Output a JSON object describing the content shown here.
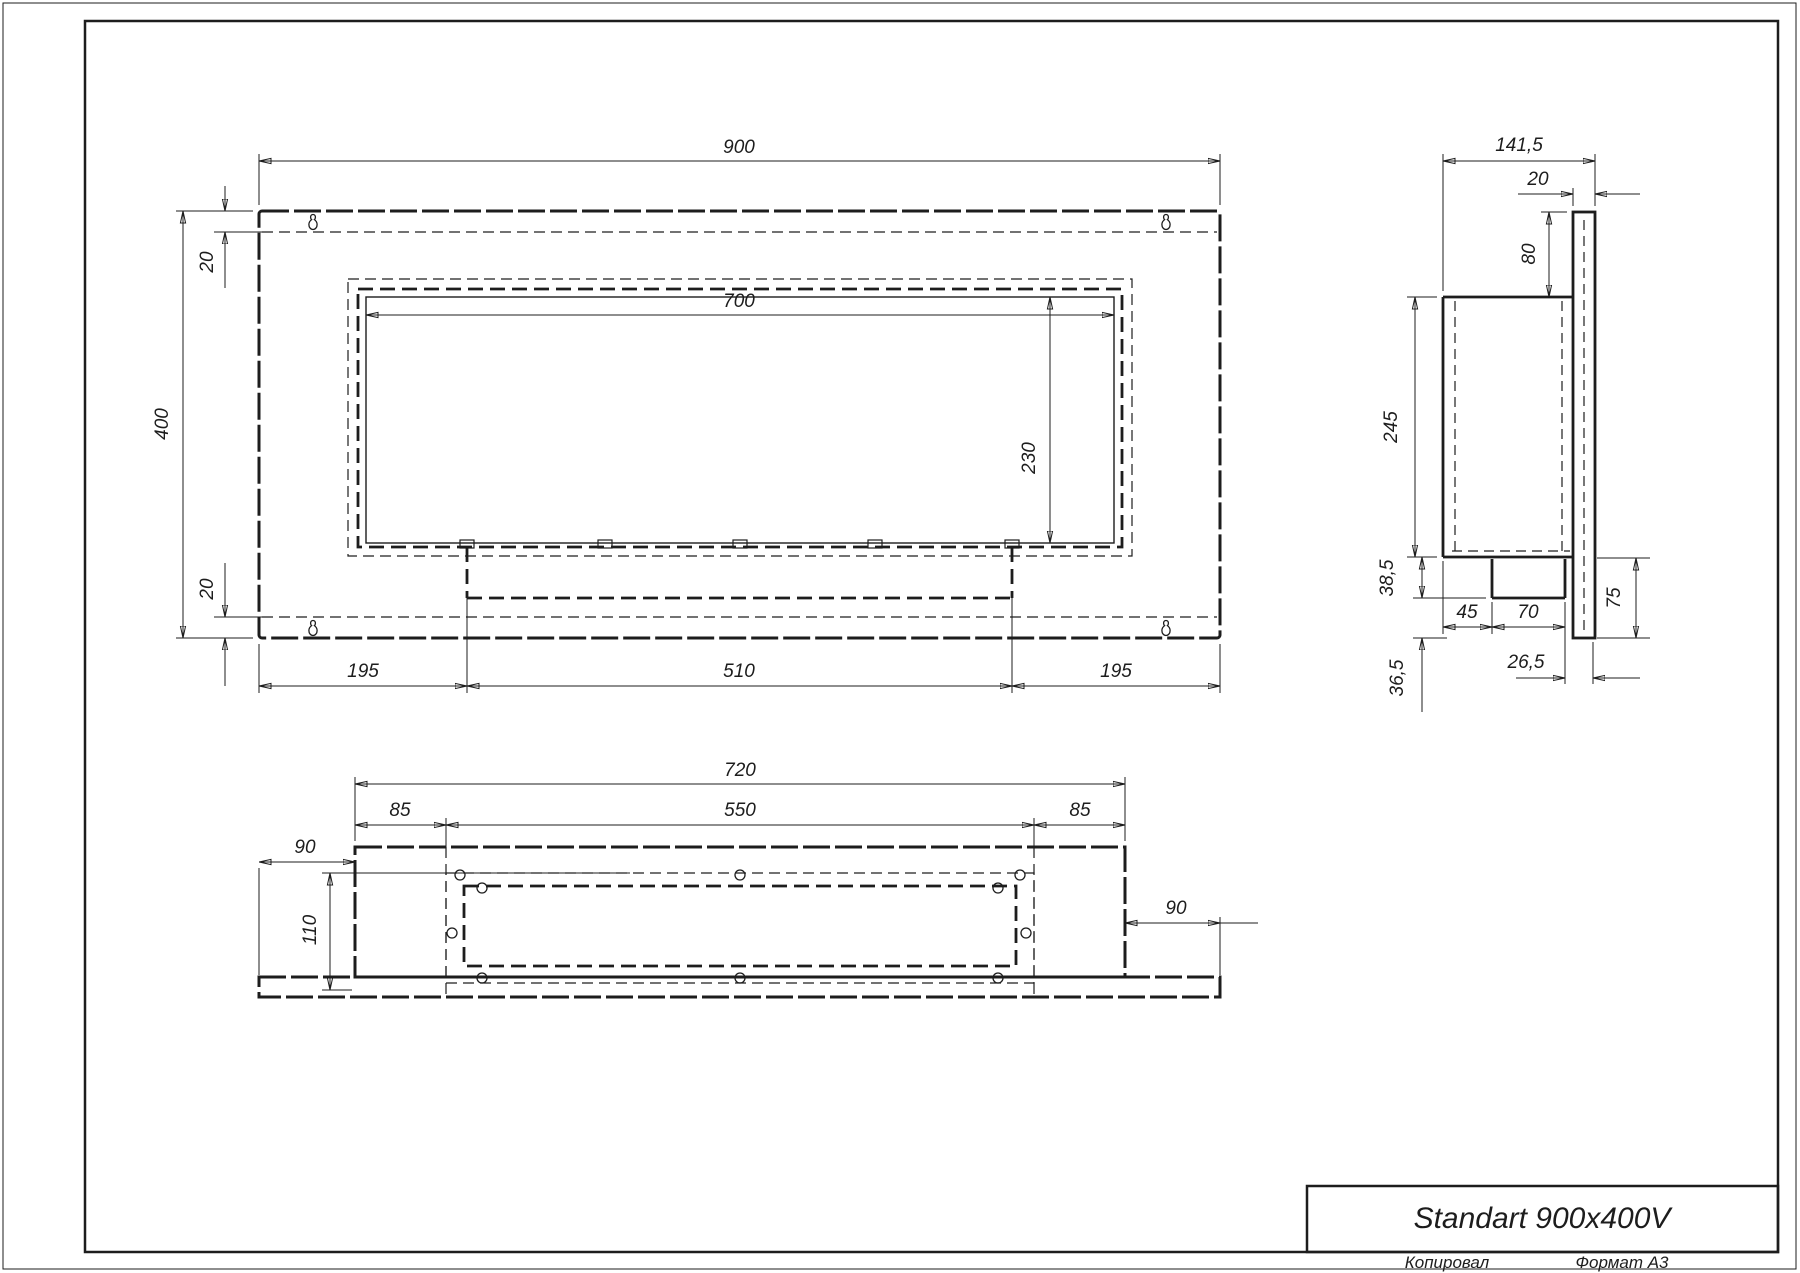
{
  "drawing": {
    "title": "Standart 900x400V",
    "footer": {
      "left": "Копировал",
      "right": "Формат А3"
    },
    "colors": {
      "ink": "#1d1d1d",
      "paper": "#ffffff"
    },
    "views": {
      "front": {
        "overall_width": "900",
        "overall_height": "400",
        "flange_top": "20",
        "flange_bottom": "20",
        "opening_width": "700",
        "opening_height": "230",
        "left_margin": "195",
        "burner_width": "510",
        "right_margin": "195"
      },
      "side": {
        "overall_depth": "141,5",
        "panel_thickness": "20",
        "top_offset": "80",
        "box_height": "245",
        "burner_drop": "38,5",
        "burner_setback": "45",
        "burner_depth": "70",
        "lower_height": "75",
        "lower_lip": "26,5",
        "lower_gap": "36,5"
      },
      "bottom": {
        "box_width": "720",
        "left_margin": "85",
        "opening_width": "550",
        "right_margin": "85",
        "panel_left_margin": "90",
        "body_depth": "110",
        "panel_right_margin": "90"
      }
    }
  }
}
